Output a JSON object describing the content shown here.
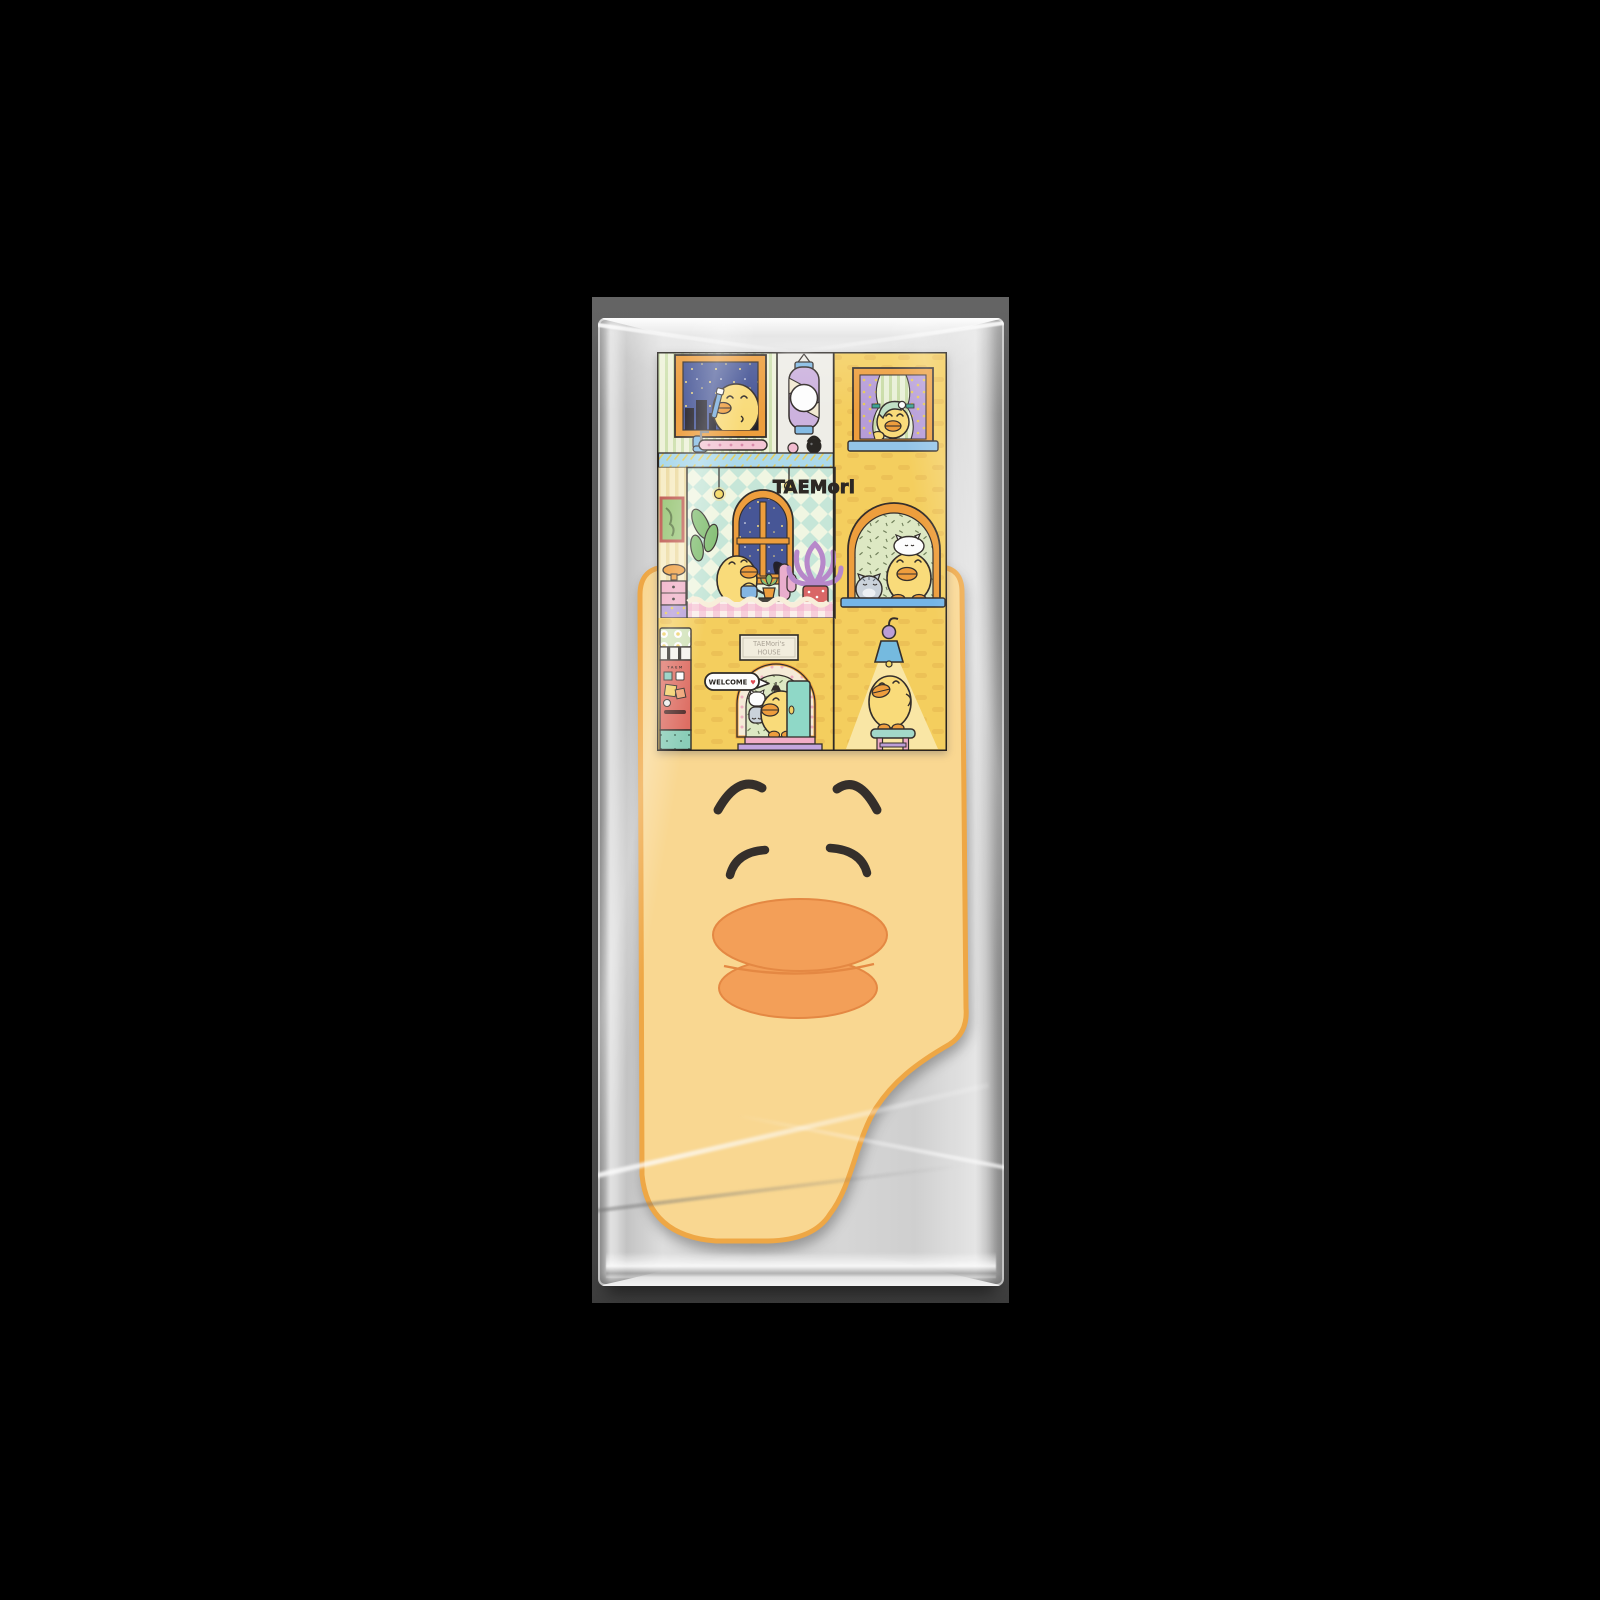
{
  "scene": {
    "canvas_bg": "#000000",
    "photo_bg": "#575757",
    "package_shadow": "#3d3d3d",
    "package_silver": "#cdcdcd",
    "package_highlight": "#ffffff"
  },
  "card": {
    "logo_text": "TAEMori",
    "house_sign_line1": "TAEMori's",
    "house_sign_line2": "HOUSE",
    "welcome_text": "WELCOME",
    "welcome_heart": "♥",
    "heart_color": "#e0434d",
    "vending_label": "TAEM",
    "wall_yellow": "#f6ce57",
    "night_blue": "#3e4e92",
    "ledge_blue": "#a9d9ec",
    "frame_orange": "#ef9b33",
    "machine_red": "#dd685c",
    "door_mint": "#8bd8c6",
    "step_pink": "#f3abc6",
    "step_purple": "#c2a3dd",
    "duck_yellow": "#fbdb74",
    "sill_blue": "#6fb3e8"
  },
  "plush": {
    "kind": "duck-face towel",
    "body_yellow": "#fbd78d",
    "outline_orange": "#f0a43c",
    "bill_orange": "#f59c50",
    "bill_edge": "#e5833a",
    "face_black": "#2b2520"
  }
}
